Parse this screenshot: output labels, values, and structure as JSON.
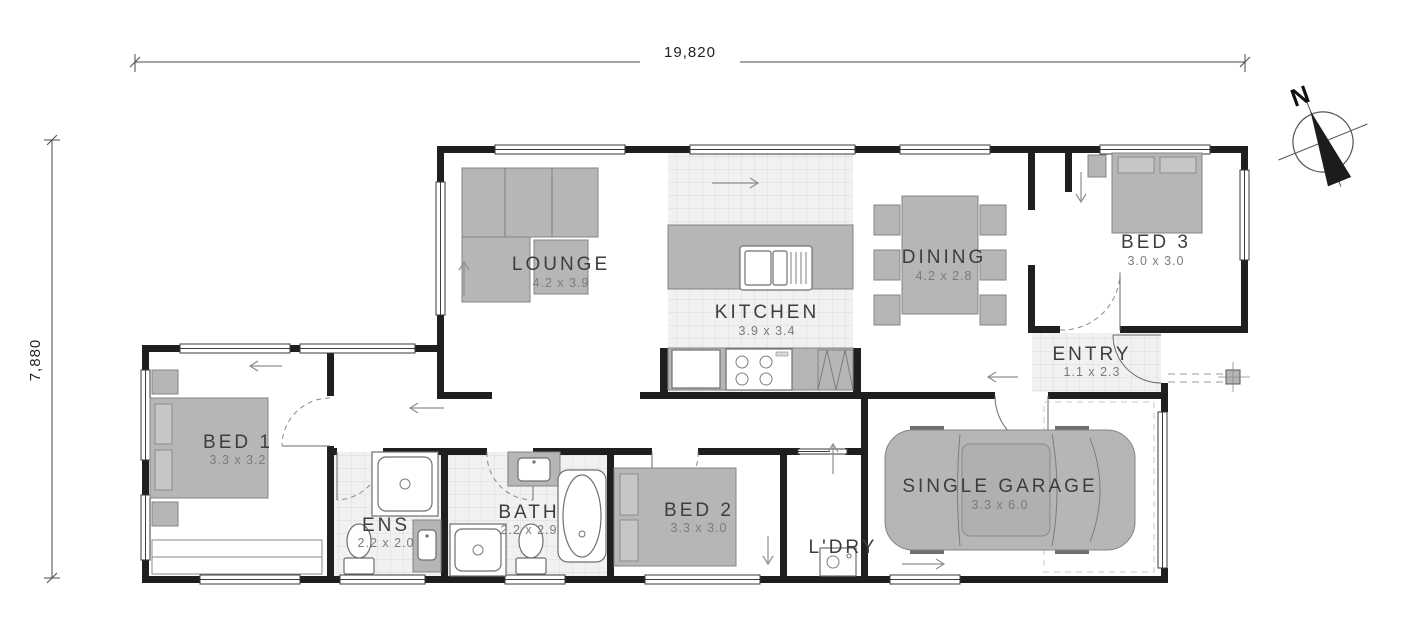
{
  "dimensions": {
    "top": "19,820",
    "left": "7,880"
  },
  "compass": {
    "label": "N"
  },
  "rooms": [
    {
      "id": "lounge",
      "name": "LOUNGE",
      "size": "4.2 x 3.9"
    },
    {
      "id": "kitchen",
      "name": "KITCHEN",
      "size": "3.9 x 3.4"
    },
    {
      "id": "dining",
      "name": "DINING",
      "size": "4.2 x 2.8"
    },
    {
      "id": "bed3",
      "name": "BED 3",
      "size": "3.0 x 3.0"
    },
    {
      "id": "entry",
      "name": "ENTRY",
      "size": "1.1 x 2.3"
    },
    {
      "id": "bed1",
      "name": "BED 1",
      "size": "3.3 x 3.2"
    },
    {
      "id": "ens",
      "name": "ENS",
      "size": "2.2 x 2.0"
    },
    {
      "id": "bath",
      "name": "BATH",
      "size": "2.2 x 2.9"
    },
    {
      "id": "bed2",
      "name": "BED 2",
      "size": "3.3 x 3.0"
    },
    {
      "id": "ldry",
      "name": "L'DRY",
      "size": ""
    },
    {
      "id": "garage",
      "name": "SINGLE GARAGE",
      "size": "3.3 x 6.0"
    }
  ],
  "colors": {
    "wall": "#1f1f1f",
    "furniture": "#b6b6b6",
    "tile": "#f1f1f1"
  }
}
